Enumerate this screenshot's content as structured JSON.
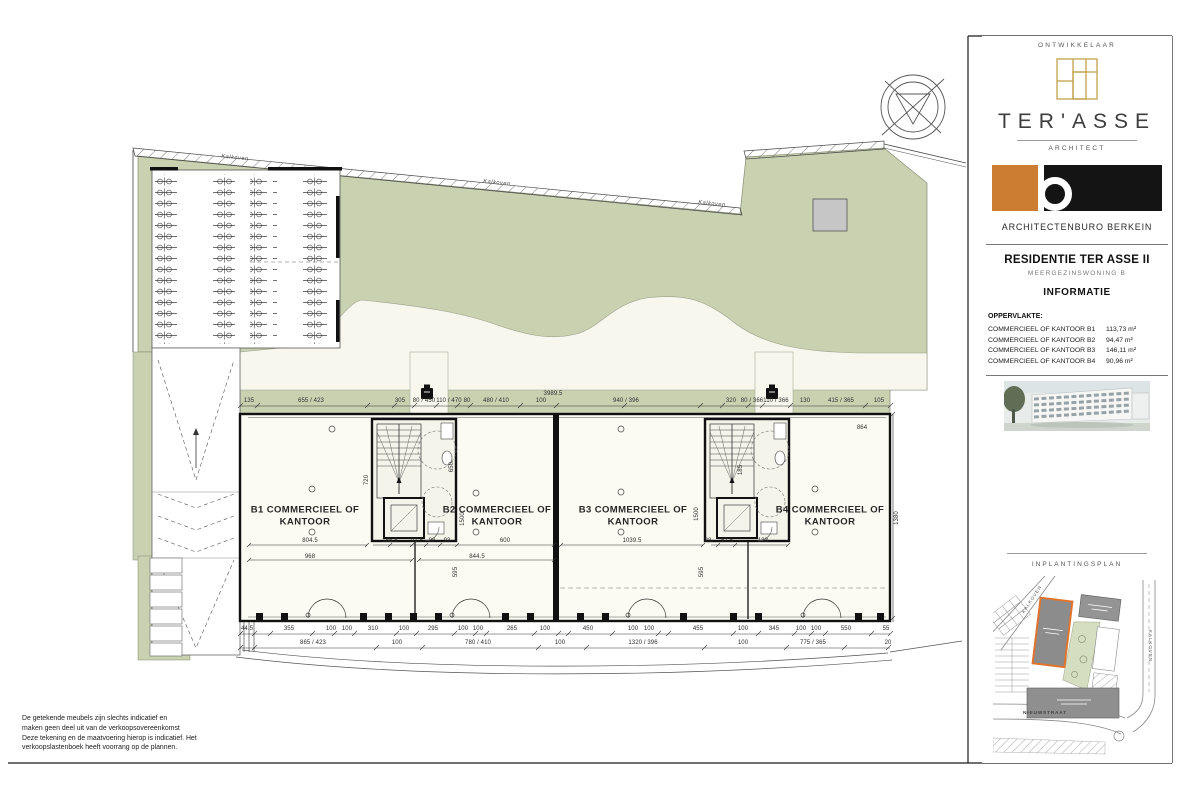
{
  "sheet": {
    "disclaimer": [
      "De getekende meubels zijn slechts indicatief en",
      "maken geen deel uit van de verkoopsovereenkomst",
      "Deze tekening en de maatvoering hierop is indicatief. Het",
      "verkoopslastenboek heeft voorrang op de plannen."
    ]
  },
  "sidebar": {
    "developer_label": "ONTWIKKELAAR",
    "developer_name": "TER'ASSE",
    "architect_label": "ARCHITECT",
    "architect_name": "ARCHITECTENBURO BERKEIN",
    "project": {
      "title": "RESIDENTIE TER ASSE II",
      "subtitle": "MEERGEZINSWONING B"
    },
    "info_title": "INFORMATIE",
    "surface_label": "OPPERVLAKTE:",
    "areas": [
      {
        "label": "COMMERCIEEL OF KANTOOR B1",
        "value": "113,73 m²"
      },
      {
        "label": "COMMERCIEEL OF KANTOOR B2",
        "value": "94,47 m²"
      },
      {
        "label": "COMMERCIEEL OF KANTOOR B3",
        "value": "146,11 m²"
      },
      {
        "label": "COMMERCIEEL OF KANTOOR B4",
        "value": "90,96 m²"
      }
    ],
    "siteplan_label": "INPLANTINGSPLAN",
    "streets": {
      "topleft": "KALKOVEN",
      "right": "KALKOVEN",
      "bottom": "NIEUWSTRAAT"
    }
  },
  "plan": {
    "unit_labels": [
      {
        "t": "B1 COMMERCIEEL OF KANTOOR",
        "x": 305,
        "y": 516
      },
      {
        "t": "B2 COMMERCIEEL OF KANTOOR",
        "x": 497,
        "y": 516
      },
      {
        "t": "B3 COMMERCIEEL OF KANTOOR",
        "x": 633,
        "y": 516
      },
      {
        "t": "B4 COMMERCIEEL OF KANTOOR",
        "x": 830,
        "y": 516
      }
    ],
    "boundary_labels": [
      {
        "t": "Kalkoven",
        "x": 235,
        "y": 158,
        "r": 6
      },
      {
        "t": "Kalkoven",
        "x": 497,
        "y": 183,
        "r": 6
      },
      {
        "t": "Kalkoven",
        "x": 712,
        "y": 204,
        "r": 6
      }
    ],
    "dim_labels": [
      {
        "t": "3989.5",
        "x": 553,
        "y": 394
      },
      {
        "t": "135",
        "x": 249,
        "y": 401
      },
      {
        "t": "655 / 423",
        "x": 311,
        "y": 401
      },
      {
        "t": "305",
        "x": 400,
        "y": 401
      },
      {
        "t": "80 / 450",
        "x": 424,
        "y": 401
      },
      {
        "t": "110 / 470",
        "x": 449,
        "y": 401
      },
      {
        "t": "80",
        "x": 467,
        "y": 401
      },
      {
        "t": "480 / 410",
        "x": 496,
        "y": 401
      },
      {
        "t": "100",
        "x": 541,
        "y": 401
      },
      {
        "t": "940 / 396",
        "x": 626,
        "y": 401
      },
      {
        "t": "320",
        "x": 731,
        "y": 401
      },
      {
        "t": "80 / 366",
        "x": 752,
        "y": 401
      },
      {
        "t": "110 / 366",
        "x": 776,
        "y": 401
      },
      {
        "t": "130",
        "x": 805,
        "y": 401
      },
      {
        "t": "415 / 365",
        "x": 841,
        "y": 401
      },
      {
        "t": "105",
        "x": 879,
        "y": 401
      },
      {
        "t": "864",
        "x": 862,
        "y": 428
      },
      {
        "t": "804.5",
        "x": 310,
        "y": 541
      },
      {
        "t": "165.5",
        "x": 390,
        "y": 541
      },
      {
        "t": "91.5",
        "x": 417,
        "y": 541
      },
      {
        "t": "98",
        "x": 432,
        "y": 541
      },
      {
        "t": "93",
        "x": 447,
        "y": 541
      },
      {
        "t": "600",
        "x": 505,
        "y": 541
      },
      {
        "t": "1039.5",
        "x": 632,
        "y": 541
      },
      {
        "t": "28",
        "x": 708,
        "y": 541
      },
      {
        "t": "57.5",
        "x": 727,
        "y": 541
      },
      {
        "t": "183",
        "x": 763,
        "y": 541
      },
      {
        "t": "968",
        "x": 310,
        "y": 557
      },
      {
        "t": "844.5",
        "x": 477,
        "y": 557
      },
      {
        "t": "720",
        "x": 367,
        "y": 480,
        "r": -90
      },
      {
        "t": "650",
        "x": 452,
        "y": 467,
        "r": -90
      },
      {
        "t": "1500",
        "x": 463,
        "y": 519,
        "r": -90
      },
      {
        "t": "1500",
        "x": 697,
        "y": 514,
        "r": -90
      },
      {
        "t": "185",
        "x": 741,
        "y": 470,
        "r": -90
      },
      {
        "t": "595",
        "x": 456,
        "y": 572,
        "r": -90
      },
      {
        "t": "595",
        "x": 702,
        "y": 572,
        "r": -90
      },
      {
        "t": "1380",
        "x": 897,
        "y": 518,
        "r": -90
      },
      {
        "t": "44.5",
        "x": 247,
        "y": 629
      },
      {
        "t": "355",
        "x": 289,
        "y": 629
      },
      {
        "t": "100",
        "x": 331,
        "y": 629
      },
      {
        "t": "100",
        "x": 347,
        "y": 629
      },
      {
        "t": "310",
        "x": 373,
        "y": 629
      },
      {
        "t": "100",
        "x": 404,
        "y": 629
      },
      {
        "t": "295",
        "x": 433,
        "y": 629
      },
      {
        "t": "100",
        "x": 463,
        "y": 629
      },
      {
        "t": "100",
        "x": 478,
        "y": 629
      },
      {
        "t": "265",
        "x": 512,
        "y": 629
      },
      {
        "t": "100",
        "x": 545,
        "y": 629
      },
      {
        "t": "450",
        "x": 588,
        "y": 629
      },
      {
        "t": "100",
        "x": 633,
        "y": 629
      },
      {
        "t": "100",
        "x": 649,
        "y": 629
      },
      {
        "t": "455",
        "x": 698,
        "y": 629
      },
      {
        "t": "100",
        "x": 743,
        "y": 629
      },
      {
        "t": "345",
        "x": 774,
        "y": 629
      },
      {
        "t": "100",
        "x": 801,
        "y": 629
      },
      {
        "t": "100",
        "x": 816,
        "y": 629
      },
      {
        "t": "550",
        "x": 846,
        "y": 629
      },
      {
        "t": "55",
        "x": 886,
        "y": 629
      },
      {
        "t": "865 / 423",
        "x": 313,
        "y": 643
      },
      {
        "t": "100",
        "x": 397,
        "y": 643
      },
      {
        "t": "780 / 410",
        "x": 478,
        "y": 643
      },
      {
        "t": "100",
        "x": 560,
        "y": 643
      },
      {
        "t": "1320 / 396",
        "x": 643,
        "y": 643
      },
      {
        "t": "100",
        "x": 743,
        "y": 643
      },
      {
        "t": "775 / 365",
        "x": 813,
        "y": 643
      },
      {
        "t": "20",
        "x": 888,
        "y": 643
      }
    ]
  }
}
